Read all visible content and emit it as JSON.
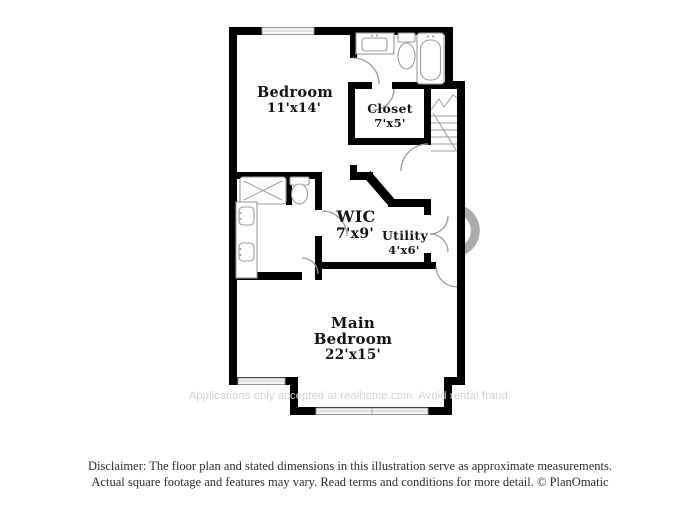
{
  "colors": {
    "background": "#ffffff",
    "wall": "#000000",
    "fixture_line": "#9b9b9b",
    "room_label": "#141414",
    "watermark_text": "#d2d2d2",
    "watermark_mark": "#ababab",
    "disclaimer_text": "#2e2e2e"
  },
  "plan": {
    "rooms": [
      {
        "id": "bedroom",
        "name": "Bedroom",
        "dims": "11'x14'"
      },
      {
        "id": "closet",
        "name": "Closet",
        "dims": "7'x5'"
      },
      {
        "id": "wic",
        "name": "WIC",
        "dims": "7'x9'"
      },
      {
        "id": "utility",
        "name": "Utility",
        "dims": "4'x6'"
      },
      {
        "id": "main-bedroom",
        "name_line1": "Main",
        "name_line2": "Bedroom",
        "dims": "22'x15'"
      }
    ],
    "fixtures": [
      "vanity-sink",
      "toilet",
      "bathtub",
      "stairs",
      "shower",
      "toilet",
      "double-vanity-sinks"
    ],
    "windows": 3,
    "doors": 8
  },
  "watermark": {
    "text": "Applications only accepted at realhome.com. Avoid rental fraud."
  },
  "disclaimer": {
    "line1": "Disclaimer: The floor plan and stated dimensions in this illustration serve as approximate measurements.",
    "line2": "Actual square footage and features may vary. Read terms and conditions for more detail. © PlanOmatic"
  }
}
